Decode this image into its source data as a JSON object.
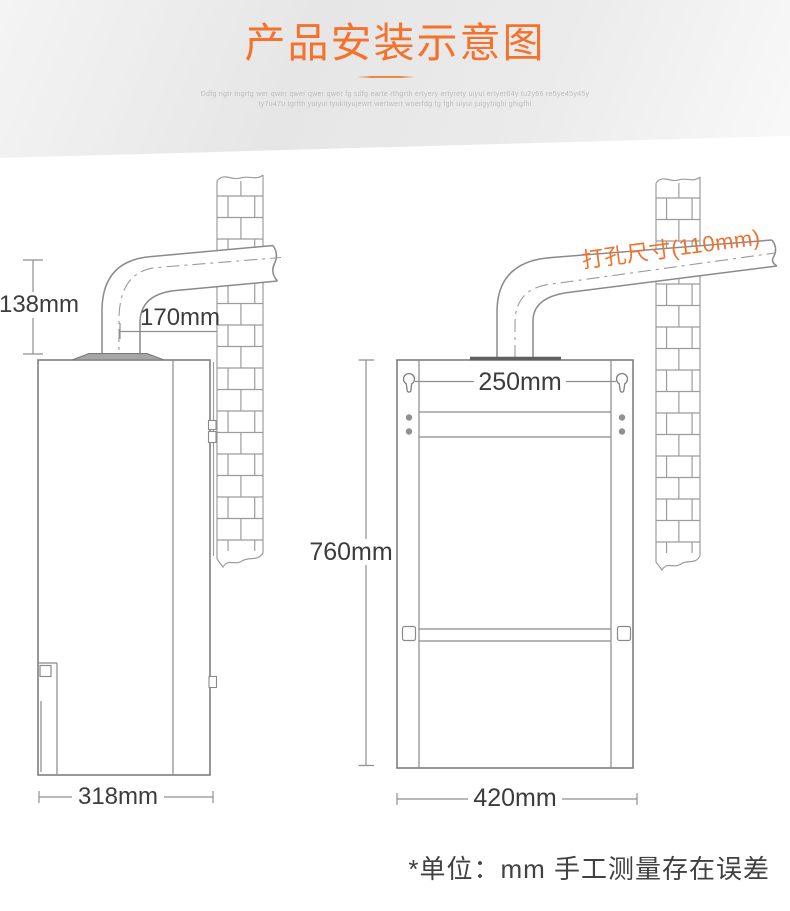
{
  "header": {
    "title": "产品安装示意图",
    "tagline_line1": "Ddfg ngtr tngrtg wer qwer qwer qwer qwer fg sdfg earte rthgrth ertyery ertyrety uiyui ertyer64y tu2y66 re5ye45y45y",
    "tagline_line2": "ty7u47u tgrfth yuiyui tyukityujewrt wertwert woerfdg fg fgh uiyui juigyhighi ghigfhi"
  },
  "side_view": {
    "flue_height_label": "138mm",
    "flue_to_wall_label": "170mm",
    "body_depth_label": "318mm"
  },
  "front_view": {
    "drill_hole_label": "打孔尺寸(110mm)",
    "bracket_spacing_label": "250mm",
    "body_height_label": "760mm",
    "body_width_label": "420mm"
  },
  "footnote": "*单位：mm 手工测量存在误差",
  "colors": {
    "accent_orange": "#f6712b",
    "line_gray": "#8a8a8a",
    "brick_gray": "#9c9c9c",
    "dim_text": "#3c3c3c",
    "tagline_gray": "#bcbcbc",
    "footnote_text": "#414141"
  }
}
